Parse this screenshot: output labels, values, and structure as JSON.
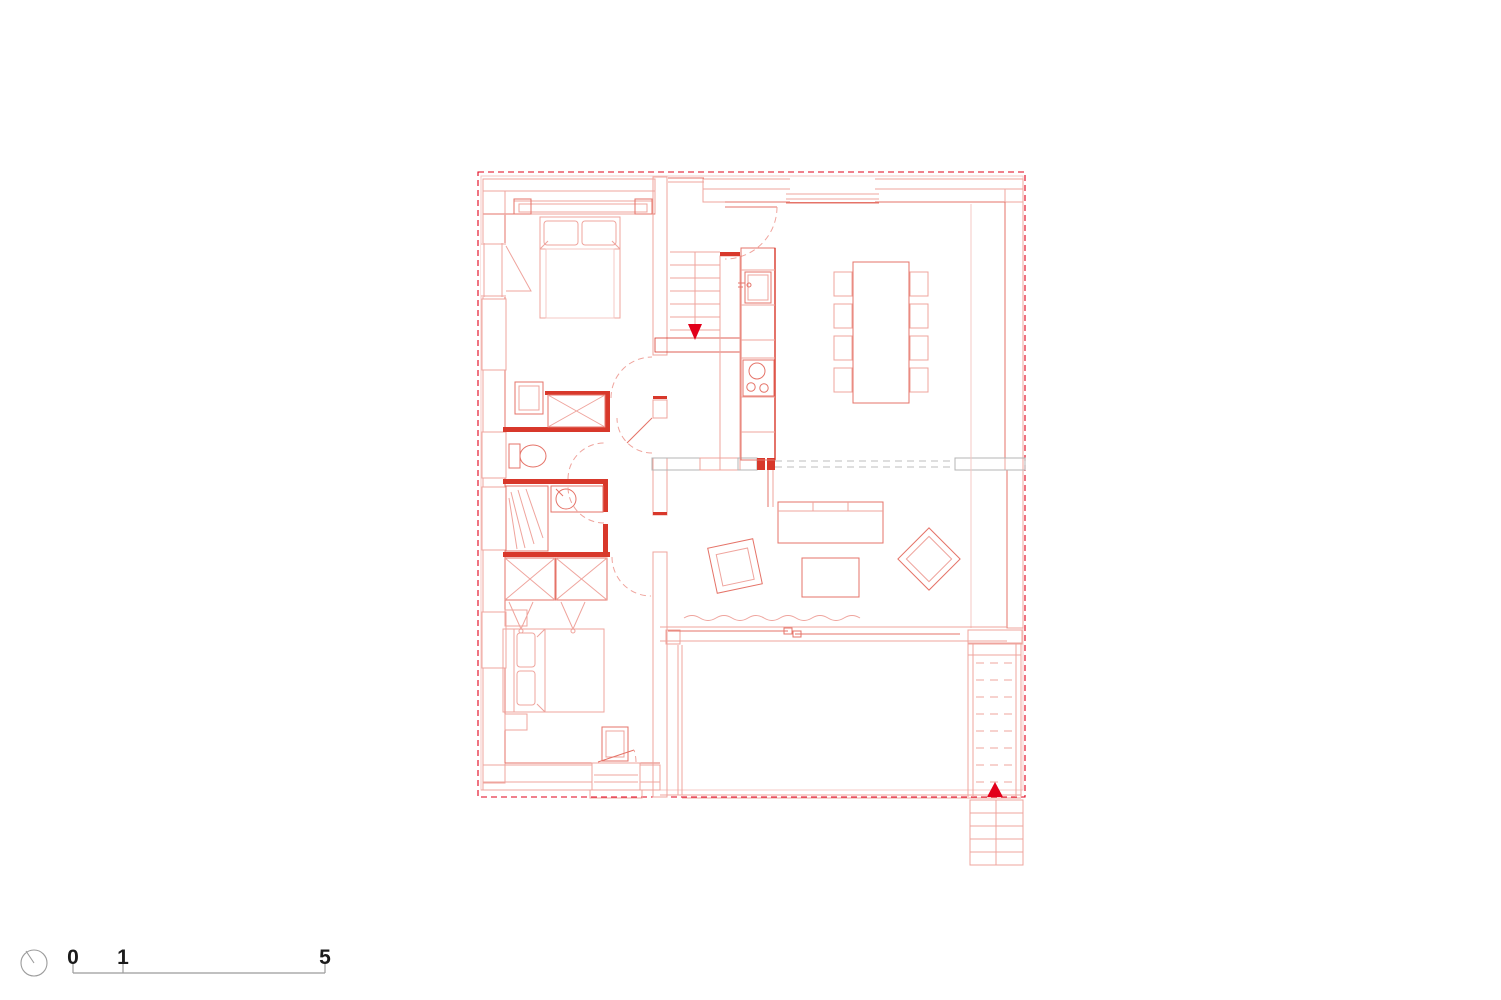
{
  "page": {
    "background": "#ffffff",
    "drawing_type": "architectural-floor-plan"
  },
  "colors": {
    "accent_red": "#e2001a",
    "strong_red": "#d8382b",
    "medium_red": "#e57368",
    "light_red": "#efa49d",
    "pale_red": "#f6c9c4",
    "hatch_gray": "#b4b4b4",
    "dash_gray": "#bdbdbd",
    "scale_gray": "#9b9b9b",
    "dark_text": "#1b1b1b",
    "background": "#ffffff"
  },
  "scale_bar": {
    "tick_labels": [
      "0",
      "1",
      "5"
    ]
  },
  "floor_plan": {
    "stairs": {
      "interior_stair_arrow": "down",
      "exterior_stair_arrow": "up"
    },
    "rooms": [
      {
        "name": "bedroom-north",
        "symbols": [
          "double-bed",
          "built-in-closet",
          "nightstand",
          "dresser"
        ]
      },
      {
        "name": "kitchen-dining",
        "symbols": [
          "kitchen-counter",
          "sink",
          "cooktop",
          "dining-table",
          "chairs-x8"
        ]
      },
      {
        "name": "wc",
        "symbols": [
          "toilet"
        ]
      },
      {
        "name": "bathroom",
        "symbols": [
          "shower",
          "washbasin"
        ]
      },
      {
        "name": "hall",
        "symbols": [
          "bifold-wardrobe"
        ]
      },
      {
        "name": "living-room",
        "symbols": [
          "sofa",
          "coffee-table",
          "armchair",
          "armchair",
          "sliding-glass-wall",
          "curtain"
        ]
      },
      {
        "name": "bedroom-south",
        "symbols": [
          "double-bed",
          "nightstand",
          "desk",
          "exterior-door"
        ]
      },
      {
        "name": "terrace",
        "symbols": [
          "exterior-stairs"
        ]
      }
    ]
  }
}
